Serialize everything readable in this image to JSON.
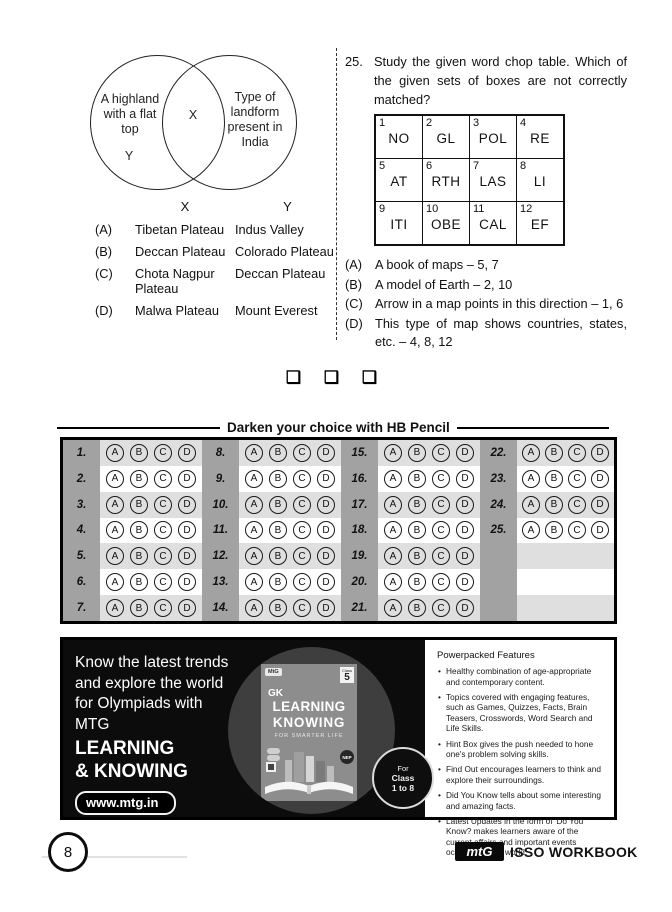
{
  "venn": {
    "left_label": "A highland with a flat top",
    "left_var": "Y",
    "intersection_var": "X",
    "right_label": "Type of landform present in India",
    "header_x": "X",
    "header_y": "Y",
    "options": [
      {
        "label": "(A)",
        "x": "Tibetan Plateau",
        "y": "Indus Valley"
      },
      {
        "label": "(B)",
        "x": "Deccan Plateau",
        "y": "Colorado Plateau"
      },
      {
        "label": "(C)",
        "x": "Chota Nagpur Plateau",
        "y": "Deccan Plateau"
      },
      {
        "label": "(D)",
        "x": "Malwa Plateau",
        "y": "Mount Everest"
      }
    ]
  },
  "q25": {
    "number": "25.",
    "text": "Study the given word chop table. Which of the given sets of boxes are not correctly matched?",
    "cells": [
      {
        "n": "1",
        "t": "NO"
      },
      {
        "n": "2",
        "t": "GL"
      },
      {
        "n": "3",
        "t": "POL"
      },
      {
        "n": "4",
        "t": "RE"
      },
      {
        "n": "5",
        "t": "AT"
      },
      {
        "n": "6",
        "t": "RTH"
      },
      {
        "n": "7",
        "t": "LAS"
      },
      {
        "n": "8",
        "t": "LI"
      },
      {
        "n": "9",
        "t": "ITI"
      },
      {
        "n": "10",
        "t": "OBE"
      },
      {
        "n": "11",
        "t": "CAL"
      },
      {
        "n": "12",
        "t": "EF"
      }
    ],
    "options": [
      {
        "label": "(A)",
        "text": "A book of maps – 5, 7"
      },
      {
        "label": "(B)",
        "text": "A model of Earth – 2, 10"
      },
      {
        "label": "(C)",
        "text": "Arrow in a map points in this direction – 1, 6"
      },
      {
        "label": "(D)",
        "text": "This type of map shows countries, states, etc. – 4, 8, 12"
      }
    ]
  },
  "separator": {
    "squares": "❑ ❑ ❑"
  },
  "omr": {
    "title": "Darken your choice with HB Pencil",
    "choices": [
      "A",
      "B",
      "C",
      "D"
    ],
    "group_starts": [
      1,
      8,
      15,
      22
    ],
    "rows": 7,
    "total": 25,
    "colors": {
      "number_cell": "#a2a2a2",
      "row_shade": "#dfdfdf",
      "row_plain": "#ffffff"
    }
  },
  "ad": {
    "headline": "Know the latest trends\nand explore the world\nfor Olympiads with\nMTG",
    "brand": "LEARNING\n& KNOWING",
    "website": "www.mtg.in",
    "book": {
      "logo": "MtG",
      "class_label": "Class",
      "class_number": "5",
      "gk": "GK",
      "title1": "LEARNING",
      "title2": "KNOWING",
      "tagline": "FOR SMARTER LIFE",
      "nep": "NEP"
    },
    "class_badge": {
      "line1": "For",
      "line2": "Class",
      "line3": "1 to 8"
    },
    "features_title": "Powerpacked Features",
    "features": [
      "Healthy combination of age-appropriate and contemporary content.",
      "Topics covered with engaging features, such as Games, Quizzes, Facts, Brain Teasers, Crosswords, Word Search and Life Skills.",
      "Hint Box gives the push needed to hone one's problem solving skills.",
      "Find Out encourages learners to think and explore their surroundings.",
      "Did You Know tells about some interesting and amazing facts.",
      "Latest Updates in the form of 'Do You Know? makes learners aware of the current affairs and important events occurring in the world."
    ],
    "colors": {
      "panel": "#0c0c0c",
      "circle": "#3e3e3e",
      "cover": "#8d8d8d"
    }
  },
  "footer": {
    "page_number": "8",
    "logo": "mtG",
    "book_title": "ISSO WORKBOOK"
  }
}
